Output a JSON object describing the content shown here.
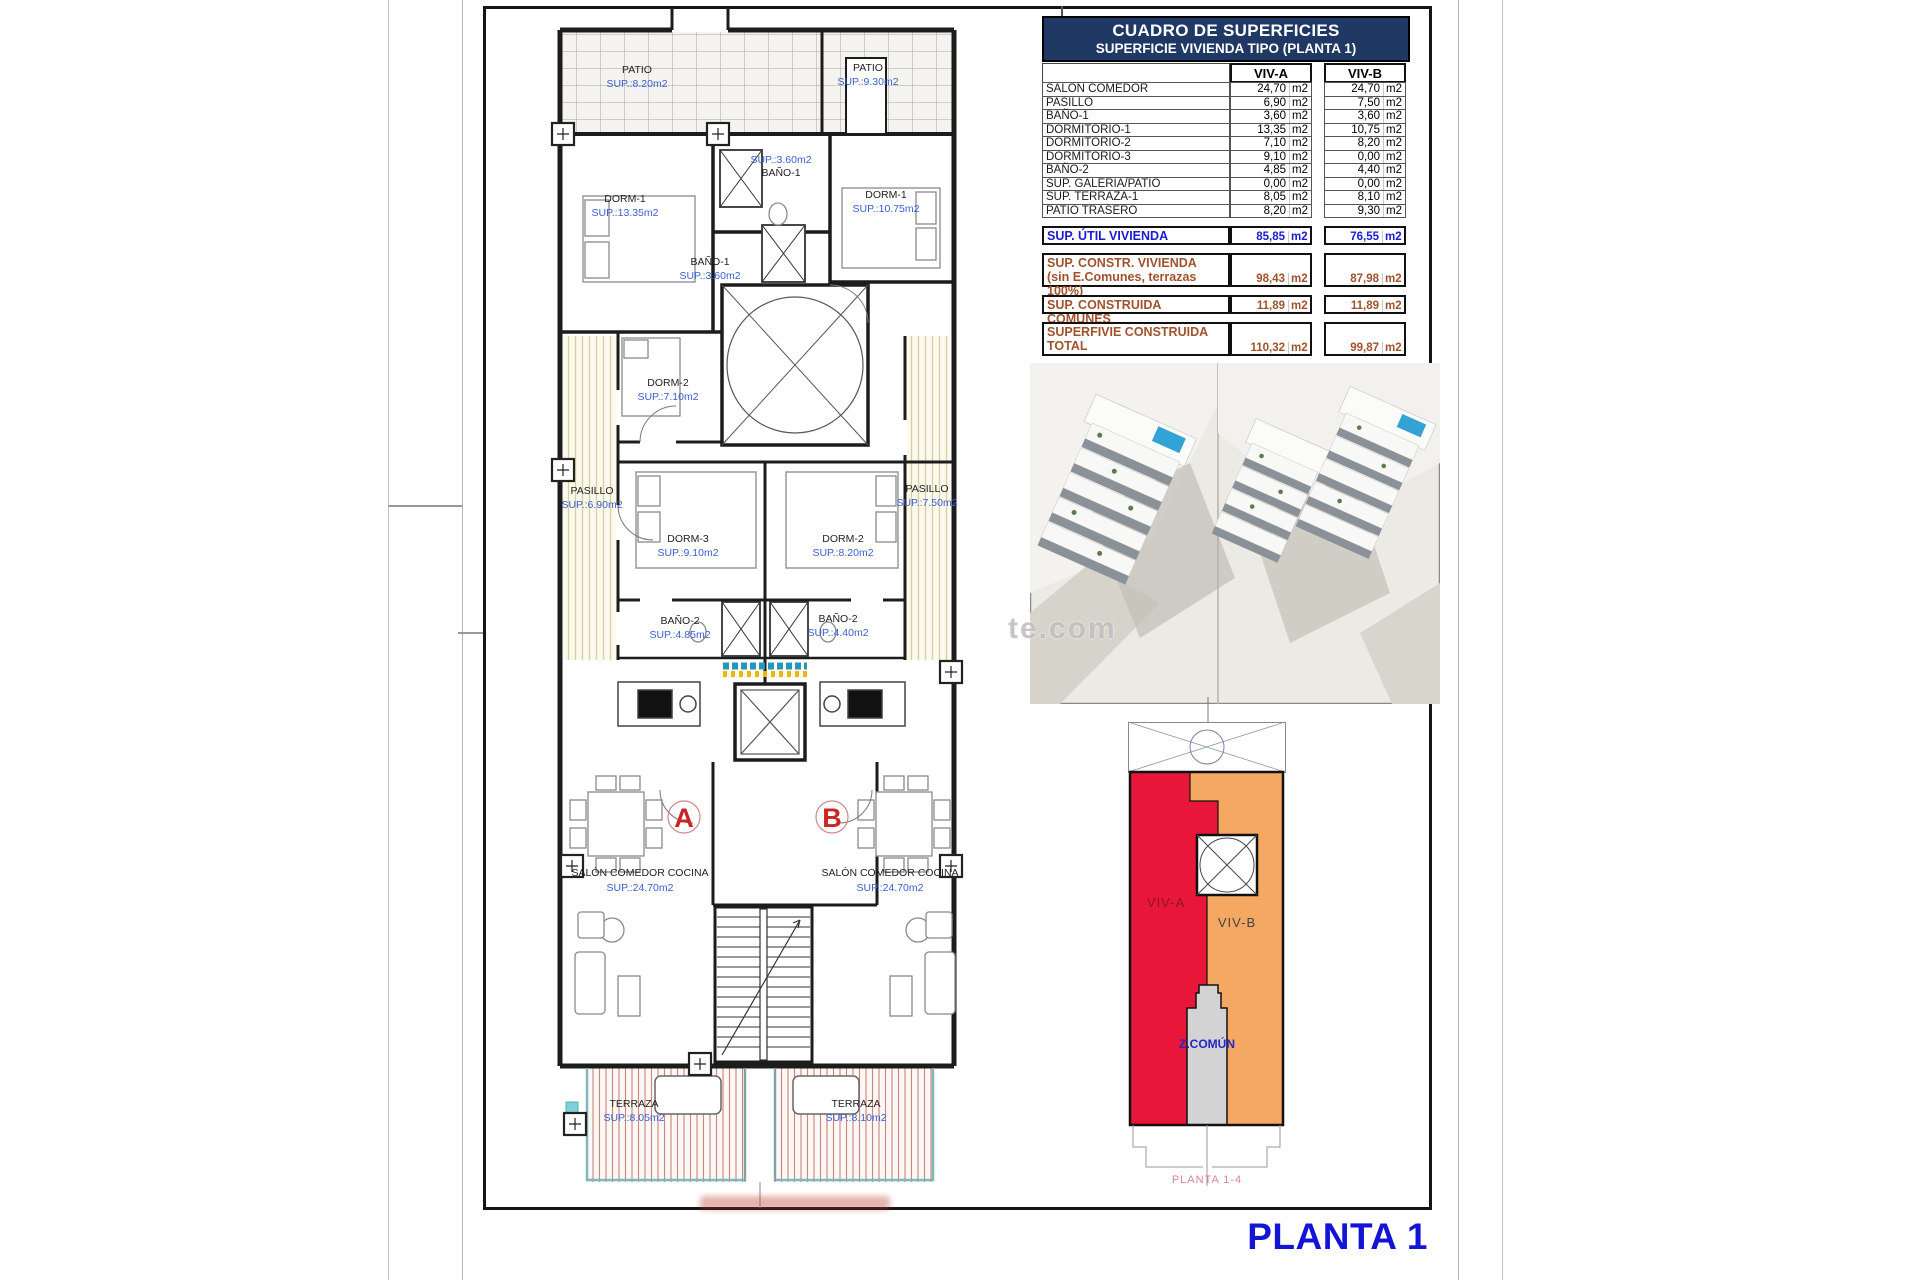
{
  "colors": {
    "header_bg": "#1F3864",
    "table_blue": "#1b1bd0",
    "table_brown": "#A0522D",
    "plan_label_blue": "#3A5FCD",
    "red_a": "#E8173A",
    "orange_b": "#F5A861",
    "comun_gray": "#D3D3D3",
    "comun_text": "#2626c4",
    "caption_pink": "#D9849B",
    "title_blue": "#1414D6",
    "red_letter": "#CC2424"
  },
  "sheet": {
    "title": "PLANTA 1",
    "watermark": "te.com",
    "schematic_caption": "PLANTA 1-4"
  },
  "table": {
    "title": "CUADRO DE SUPERFICIES",
    "subtitle": "SUPERFICIE VIVIENDA TIPO  (PLANTA 1)",
    "col_a": "VIV-A",
    "col_b": "VIV-B",
    "unit": "m2",
    "rows": [
      {
        "label": "SALON COMEDOR",
        "a": "24,70",
        "b": "24,70"
      },
      {
        "label": "PASILLO",
        "a": "6,90",
        "b": "7,50"
      },
      {
        "label": "BAÑO-1",
        "a": "3,60",
        "b": "3,60"
      },
      {
        "label": "DORMITORIO-1",
        "a": "13,35",
        "b": "10,75"
      },
      {
        "label": "DORMITORIO-2",
        "a": "7,10",
        "b": "8,20"
      },
      {
        "label": "DORMITORIO-3",
        "a": "9,10",
        "b": "0,00"
      },
      {
        "label": "BAÑO-2",
        "a": "4,85",
        "b": "4,40"
      },
      {
        "label": "SUP. GALERIA/PATIO",
        "a": "0,00",
        "b": "0,00"
      },
      {
        "label": "SUP. TERRAZA-1",
        "a": "8,05",
        "b": "8,10"
      },
      {
        "label": "PATIO TRASERO",
        "a": "8,20",
        "b": "9,30"
      }
    ],
    "summary": [
      {
        "label": "SUP. ÚTIL VIVIENDA",
        "label2": "",
        "a": "85,85",
        "b": "76,55"
      },
      {
        "label": "SUP. CONSTR. VIVIENDA",
        "label2": "(sin E.Comunes, terrazas 100%)",
        "a": "98,43",
        "b": "87,98"
      },
      {
        "label": "SUP. CONSTRUIDA COMUNES",
        "label2": "",
        "a": "11,89",
        "b": "11,89"
      },
      {
        "label": "SUPERFIVIE CONSTRUIDA",
        "label2": "TOTAL",
        "a": "110,32",
        "b": "99,87"
      }
    ]
  },
  "plan": {
    "patio_a": {
      "name": "PATIO",
      "sup": "SUP.:8.20m2"
    },
    "patio_b": {
      "name": "PATIO",
      "sup": "SUP.:9.30m2"
    },
    "dorm1_a": {
      "name": "DORM-1",
      "sup": "SUP.:13.35m2"
    },
    "dorm1_b": {
      "name": "DORM-1",
      "sup": "SUP.:10.75m2"
    },
    "bano1_top": {
      "name": "BAÑO-1",
      "sup": "SUP.:3.60m2"
    },
    "bano1_mid": {
      "name": "BAÑO-1",
      "sup": "SUP.:3.60m2"
    },
    "dorm2_a": {
      "name": "DORM-2",
      "sup": "SUP.:7.10m2"
    },
    "pasillo_a": {
      "name": "PASILLO",
      "sup": "SUP.:6.90m2"
    },
    "pasillo_b": {
      "name": "PASILLO",
      "sup": "SUP.:7.50m2"
    },
    "dorm3_a": {
      "name": "DORM-3",
      "sup": "SUP.:9.10m2"
    },
    "dorm2_b": {
      "name": "DORM-2",
      "sup": "SUP.:8.20m2"
    },
    "bano2_a": {
      "name": "BAÑO-2",
      "sup": "SUP.:4.85m2"
    },
    "bano2_b": {
      "name": "BAÑO-2",
      "sup": "SUP.:4.40m2"
    },
    "salon_a": {
      "name": "SALÓN COMEDOR COCINA",
      "sup": "SUP.:24.70m2"
    },
    "salon_b": {
      "name": "SALÓN COMEDOR COCINA",
      "sup": "SUP.:24.70m2"
    },
    "terraza_a": {
      "name": "TERRAZA",
      "sup": "SUP.:8.05m2"
    },
    "terraza_b": {
      "name": "TERRAZA",
      "sup": "SUP.:8.10m2"
    },
    "unit_a": "A",
    "unit_b": "B"
  },
  "schematic": {
    "viv_a": "VIV-A",
    "viv_b": "VIV-B",
    "comun": "Z.COMÚN"
  }
}
